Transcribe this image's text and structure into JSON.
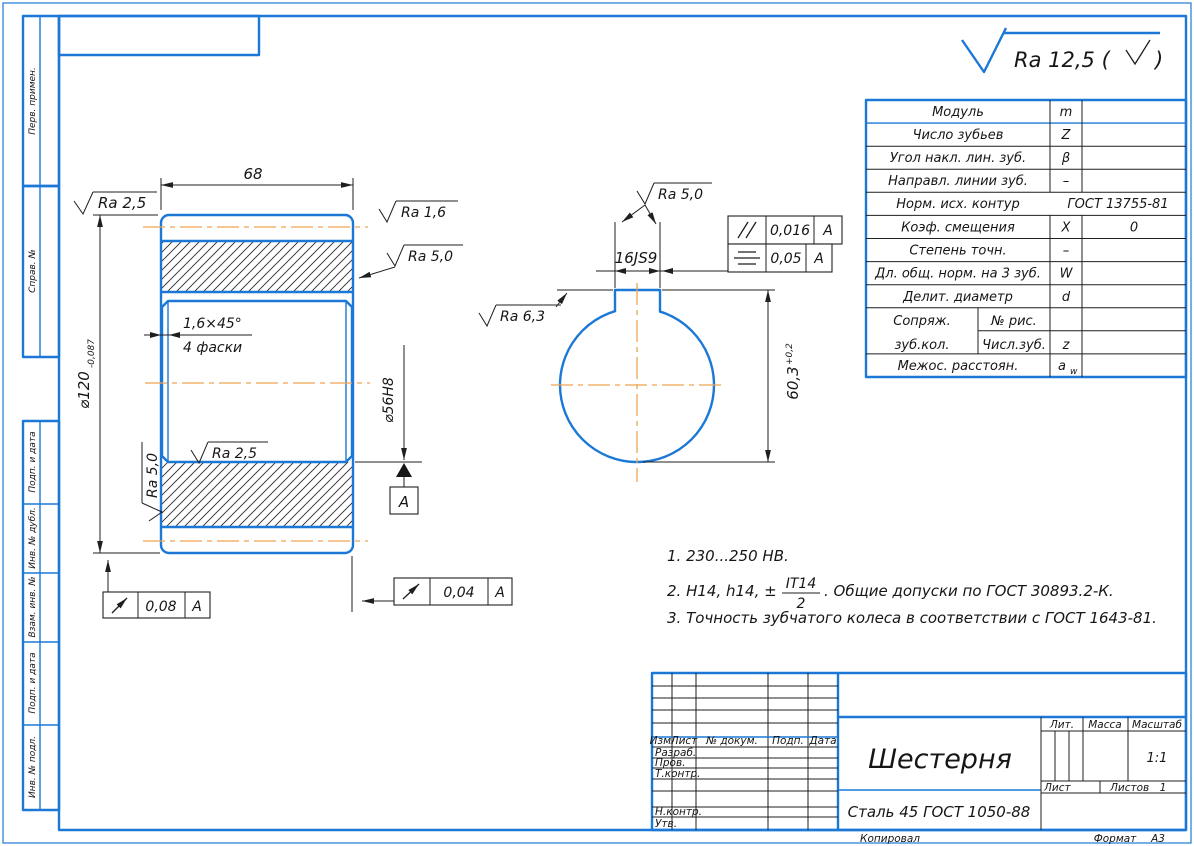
{
  "colors": {
    "line_blue": "#1b78d6",
    "centerline_orange": "#f0a452",
    "ink": "#1f1f1f"
  },
  "general_roughness": {
    "prefix": "Ra 12,5 (",
    "suffix": ")"
  },
  "margin": {
    "top_labels": [
      "Перв. примен.",
      "Справ. №"
    ],
    "bottom_labels": [
      "Подп. и дата",
      "Инв. № дубл.",
      "Взам. инв. №",
      "Подп. и дата",
      "Инв. № подл."
    ]
  },
  "left_view": {
    "dim_width": "68",
    "dim_outer": "⌀120",
    "dim_outer_tol": "-0,087",
    "dim_bore": "⌀56H8",
    "chamfer": "1,6×45°",
    "chamfer_note": "4 фаски",
    "ra_top": "Ra 2,5",
    "ra_tip": "Ra 1,6",
    "ra_flank": "Ra 5,0",
    "ra_bore": "Ra 2,5",
    "ra_face": "Ra 5,0",
    "datum": "А",
    "runout_left": {
      "value": "0,08",
      "datum": "А"
    },
    "runout_right": {
      "value": "0,04",
      "datum": "А"
    }
  },
  "right_view": {
    "ra_keyway": "Ra 5,0",
    "dim_keyway_width": "16JS9",
    "ra_hole": "Ra 6,3",
    "dim_keyway_depth": "60,3",
    "dim_keyway_depth_tol": "+0,2",
    "parallelism": {
      "value": "0,016",
      "datum": "А"
    },
    "symmetry": {
      "value": "0,05",
      "datum": "А"
    }
  },
  "param_table": {
    "rows": [
      {
        "name": "Модуль",
        "symbol": "m",
        "value": ""
      },
      {
        "name": "Число зубьев",
        "symbol": "Z",
        "value": ""
      },
      {
        "name": "Угол накл. лин. зуб.",
        "symbol": "β",
        "value": ""
      },
      {
        "name": "Направл. линии зуб.",
        "symbol": "–",
        "value": ""
      },
      {
        "name": "Норм. исх. контур",
        "symbol": "",
        "value": "ГОСТ 13755-81"
      },
      {
        "name": "Коэф. смещения",
        "symbol": "X",
        "value": "0"
      },
      {
        "name": "Степень точн.",
        "symbol": "–",
        "value": ""
      },
      {
        "name": "Дл. общ. норм. на 3 зуб.",
        "symbol": "W",
        "value": ""
      },
      {
        "name": "Делит. диаметр",
        "symbol": "d",
        "value": ""
      },
      {
        "name": "Сопряж.",
        "sub": "№ рис.",
        "symbol": "",
        "value": ""
      },
      {
        "name": "зуб.кол.",
        "sub": "Числ.зуб.",
        "symbol": "z",
        "value": ""
      },
      {
        "name": "Межос. расстоян.",
        "symbol": "a",
        "symbol_sub": "w",
        "value": ""
      }
    ]
  },
  "notes": {
    "n1": "1.  230...250 НВ.",
    "n2_prefix": "2.  H14, h14, ±",
    "n2_num": "IT14",
    "n2_den": "2",
    "n2_suffix": ".  Общие допуски по ГОСТ 30893.2-К.",
    "n3": "3.  Точность зубчатого колеса в соответствии с ГОСТ 1643-81."
  },
  "title_block": {
    "cols": {
      "izm": "Изм.",
      "list": "Лист",
      "doc": "№ докум.",
      "podp": "Подп.",
      "data": "Дата"
    },
    "rows": {
      "razrab": "Разраб.",
      "prov": "Пров.",
      "tkontr": "Т.контр.",
      "nkontr": "Н.контр.",
      "utv": "Утв."
    },
    "part_name": "Шестерня",
    "material": "Сталь 45 ГОСТ 1050-88",
    "lit_label": "Лит.",
    "mass_label": "Масса",
    "scale_label": "Масштаб",
    "scale_value": "1:1",
    "sheet_label": "Лист",
    "sheets_label": "Листов",
    "sheets_value": "1"
  },
  "footer": {
    "copied": "Копировал",
    "format_label": "Формат",
    "format_value": "А3"
  }
}
